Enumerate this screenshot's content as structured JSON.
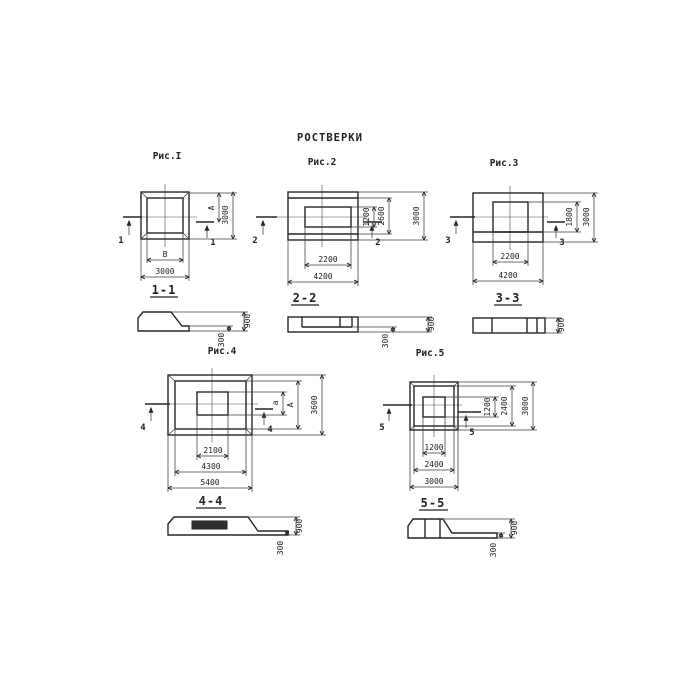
{
  "title": "РОСТВЕРКИ",
  "figures": {
    "fig1": {
      "label": "Рис.I",
      "cut": "1",
      "section_label": "1-1",
      "dims": {
        "inner_width": "В",
        "outer_width": "3000",
        "inner_height": "А",
        "outer_height": "3000"
      }
    },
    "fig2": {
      "label": "Рис.2",
      "cut": "2",
      "section_label": "2-2",
      "dims": {
        "inner_width": "2200",
        "outer_width": "4200",
        "inner_height": "1200",
        "mid_height": "2600",
        "outer_height": "3000"
      }
    },
    "fig3": {
      "label": "Рис.3",
      "cut": "3",
      "section_label": "3-3",
      "dims": {
        "inner_width": "2200",
        "outer_width": "4200",
        "inner_height": "1800",
        "outer_height": "3000"
      }
    },
    "fig4": {
      "label": "Рис.4",
      "cut": "4",
      "section_label": "4-4",
      "dims": {
        "inner_width": "2100",
        "mid_width": "4300",
        "outer_width": "5400",
        "inner_height": "а",
        "mid_height": "А",
        "outer_height": "3600"
      }
    },
    "fig5": {
      "label": "Рис.5",
      "cut": "5",
      "section_label": "5-5",
      "dims": {
        "inner_width": "1200",
        "mid_width": "2400",
        "outer_width": "3000",
        "inner_height": "1200",
        "mid_height": "2400",
        "outer_height": "3000"
      }
    }
  },
  "sections": {
    "s1": {
      "height": "900",
      "toe": "300"
    },
    "s2": {
      "height": "900",
      "toe": "300"
    },
    "s3": {
      "height": "900"
    },
    "s4": {
      "height": "900",
      "toe": "300"
    },
    "s5": {
      "height": "900",
      "toe": "300"
    }
  },
  "colors": {
    "ink": "#262626",
    "paper": "#ffffff"
  }
}
